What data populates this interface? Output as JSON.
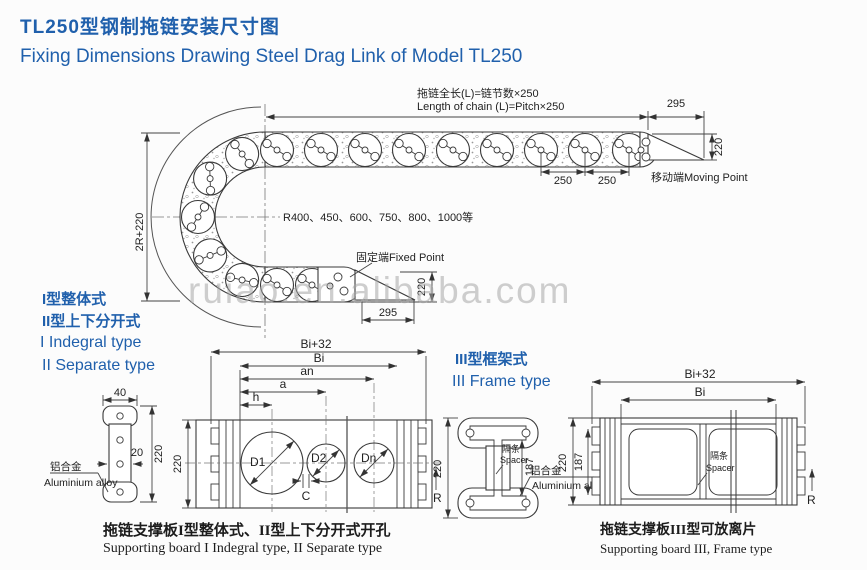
{
  "title": {
    "zh": "TL250型钢制拖链安装尺寸图",
    "en": "Fixing Dimensions Drawing Steel Drag Link of Model TL250"
  },
  "watermark": "ruiao.en.alibaba.com",
  "colors": {
    "accent_blue": "#2060ac",
    "line": "#3a3a3a",
    "watermark_gray": "#c4c4c4"
  },
  "main": {
    "formula_zh": "拖链全长(L)=链节数×250",
    "formula_en": "Length of chain (L)=Pitch×250",
    "dim_295_top": "295",
    "dim_220_move": "220",
    "dim_250_left": "250",
    "dim_250_right": "250",
    "moving_point": "移动端Moving Point",
    "radius_series": "R400、450、600、750、800、1000等",
    "fixed_point": "固定端Fixed Point",
    "dim_2r_220": "2R+220",
    "dim_220_fixed": "220",
    "dim_295_bottom": "295"
  },
  "types": {
    "t1_zh": "I型整体式",
    "t2_zh": "II型上下分开式",
    "t1_en": "I Indegral type",
    "t2_en": "II Separate type",
    "t3_zh": "III型框架式",
    "t3_en": "III Frame type"
  },
  "side_plate": {
    "dim_width": "40",
    "dim_thickness": "20",
    "dim_height": "220",
    "material_zh": "铝合金",
    "material_en": "Aluminium alloy"
  },
  "board12": {
    "dim_bi32": "Bi+32",
    "dim_bi": "Bi",
    "dim_an": "an",
    "dim_a": "a",
    "dim_h": "h",
    "dim_height": "220",
    "hole1": "D1",
    "hole2": "D2",
    "hole3": "Dn",
    "gap": "C",
    "radius": "R"
  },
  "ibeam": {
    "dim_height": "220",
    "dim_inner": "187",
    "spacer_zh": "隔条",
    "spacer_en": "Spacer",
    "material_zh": "铝合金",
    "material_en": "Aluminium alloy"
  },
  "board3": {
    "dim_bi32": "Bi+32",
    "dim_bi": "Bi",
    "dim_height": "220",
    "dim_inner": "187",
    "spacer_zh": "隔条",
    "spacer_en": "Spacer",
    "radius": "R"
  },
  "captions": {
    "board12_zh": "拖链支撑板I型整体式、II型上下分开式开孔",
    "board12_en": "Supporting board I Indegral type, II Separate type",
    "board3_zh": "拖链支撑板III型可放离片",
    "board3_en": "Supporting board III, Frame type"
  }
}
